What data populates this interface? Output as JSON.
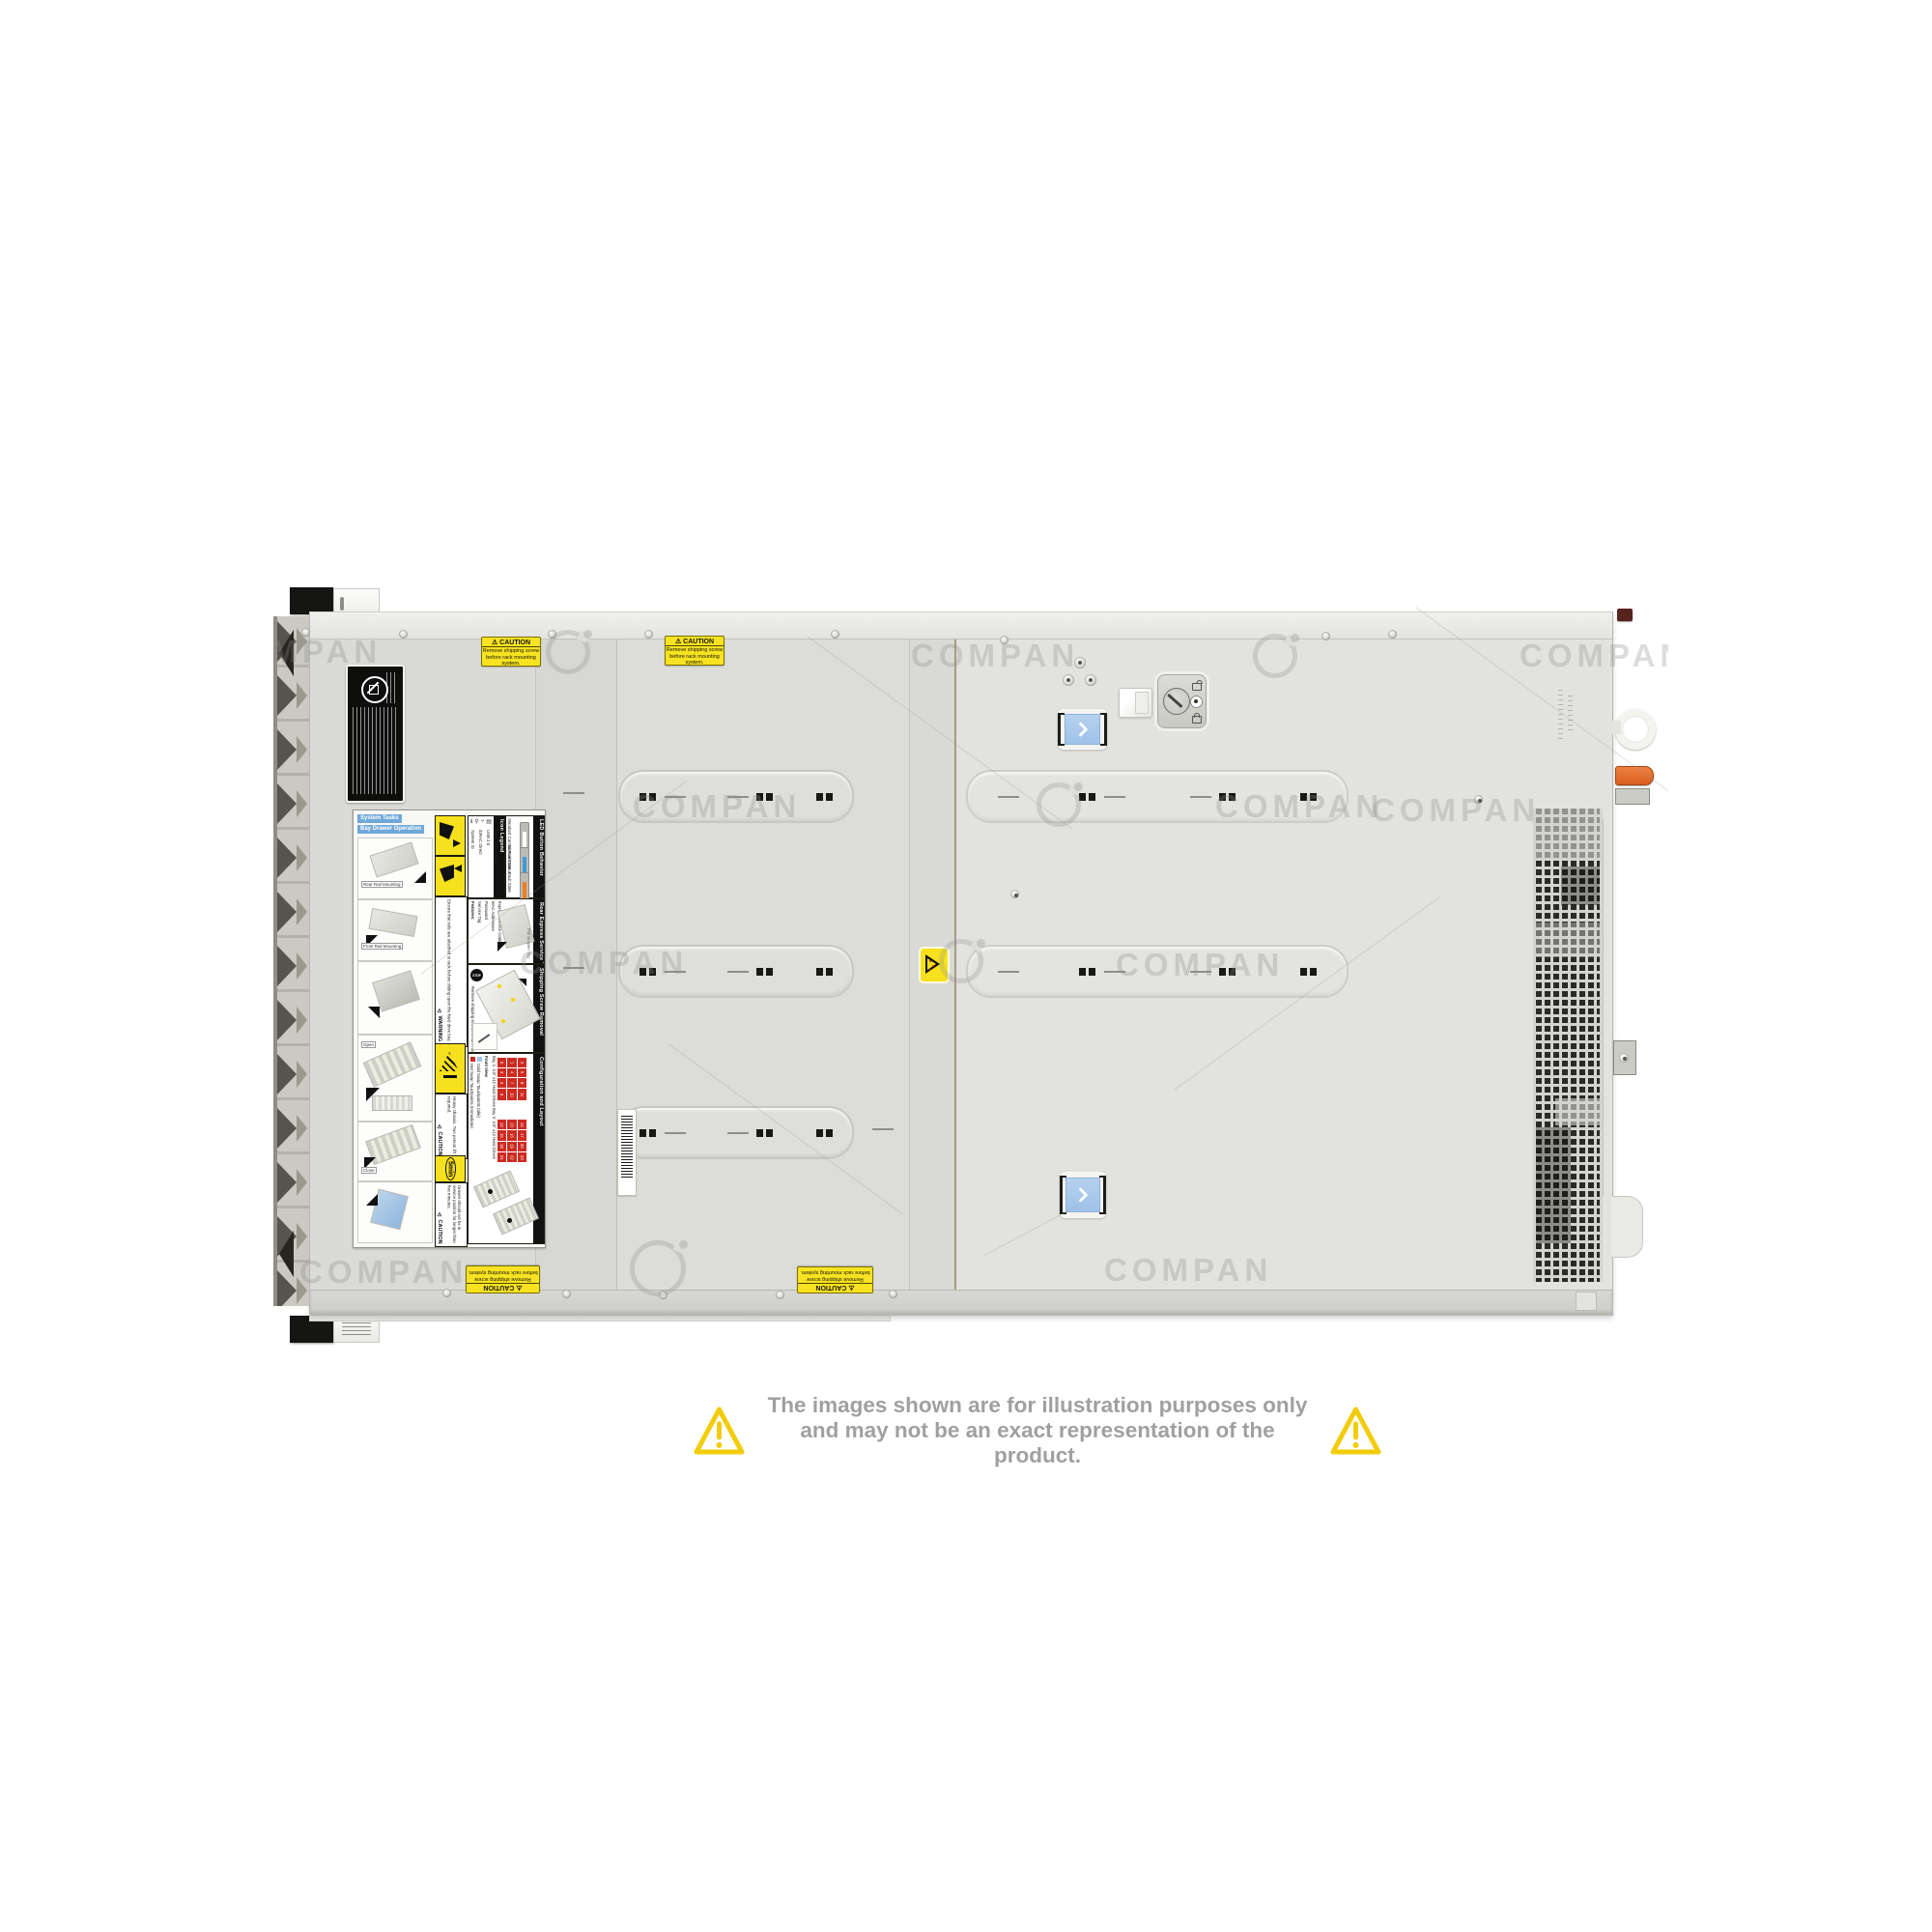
{
  "watermark": {
    "text": "COMPAN"
  },
  "caution_sticker": {
    "title": "⚠ CAUTION",
    "line1": "Remove shipping screw",
    "line2": "before rack mounting system."
  },
  "service_label": {
    "system_tasks": "System Tasks",
    "bay_drawer": "Bay Drawer Operation",
    "captions": {
      "rear_rail": "Rear Rail Mounting",
      "front_rail": "Front Rail Mounting",
      "open": "Open",
      "close": "Close"
    },
    "warning": {
      "title": "⚠ WARNING",
      "text": "Ensure that rails are attached to rack before sliding open the hard drive bay."
    },
    "caution_heavy": {
      "title": "⚠ CAUTION",
      "text": "Heavy chassis. Two person lift required."
    },
    "five_min": "5min",
    "caution_drawer": {
      "title": "⚠ CAUTION",
      "text": "Drawer should not be in service position for longer than five minutes."
    },
    "icon_legend": {
      "title": "Icon Legend",
      "items": [
        "System ID",
        "iDRAC Direct",
        "USB 2.0",
        "Hard Drive Activity"
      ]
    },
    "led": {
      "title": "LED Button Behavior",
      "subtitle": "Standard Control Panel Status",
      "normal": "Normal State",
      "fault": "Fault State",
      "colors": {
        "normal": "#ffffff",
        "info": "#3f9ad6",
        "fault": "#f07f1f"
      }
    },
    "rear_tag": {
      "title": "Rear Express Service Tag",
      "features": "Features:",
      "items": [
        "Service Tag",
        "Password",
        "MAC Addresses",
        "Express Service Code"
      ],
      "pull": "Pull to open Tag"
    },
    "shipping": {
      "title": "Shipping Screw Removal",
      "stop": "STOP",
      "text": "Remove shipping screws before rack mounting system."
    },
    "config": {
      "title": "Configuration and Layout",
      "legend_hot": "Hot Swap Touchpoints (Immediate)",
      "legend_cold": "Cold Swap Touchpoints (Idle)",
      "front_view": "Front View",
      "bay1": "Bay 1: 3.5\" x12 Hard Drives",
      "bay2": "Bay 2: 3.5\" x12 Hard Drives",
      "bay1_numbers": [
        "0",
        "1",
        "2",
        "3",
        "4",
        "5",
        "6",
        "7",
        "8",
        "9",
        "10",
        "11"
      ],
      "bay2_numbers": [
        "12",
        "13",
        "14",
        "15",
        "16",
        "17",
        "18",
        "19",
        "20",
        "21",
        "22",
        "23"
      ]
    }
  },
  "disclaimer": {
    "line1": "The images shown are for illustration purposes only",
    "line2": "and may not be an exact representation of the product."
  },
  "colors": {
    "blue_touchpoint": "#a9c9ec",
    "orange_lever": "#e0661f",
    "caution_yellow": "#f7e11e",
    "warning_triangle_yellow": "#f2cc0a"
  }
}
